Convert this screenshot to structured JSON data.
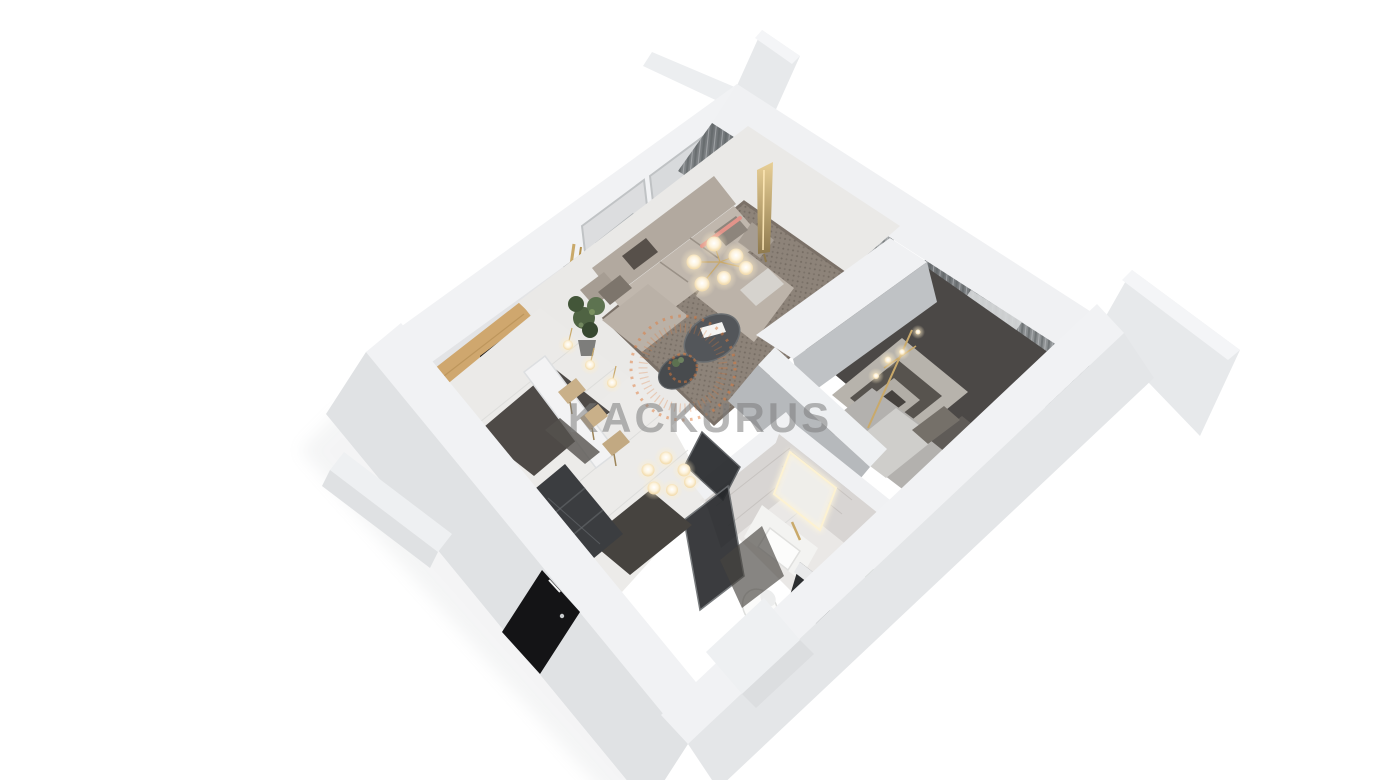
{
  "watermark": {
    "brand": "KACKURUS",
    "logo_color": "#e07a3a",
    "text_color": "#7d7d7d"
  },
  "scene": {
    "description": "3D cutaway floor-plan render of a one-bedroom apartment, viewed from above at an angle",
    "background": "#ffffff"
  },
  "palette": {
    "wall_top": "#f1f2f4",
    "wall_face_exterior": "#e2e4e6",
    "interior_wall_gray": "#a8acae",
    "curtain_dark": "#7c8083",
    "curtain_sheer": "#d9dadb",
    "sofa_beige": "#bdb4aa",
    "living_rug": "#8d8379",
    "bedroom_carpet": "#4b4846",
    "kitchen_rug": "#4e4a47",
    "wood_accent": "#cfa76e",
    "gold_accent": "#c9a96a",
    "appliance_black": "#141416",
    "marble": "#d8d5d3",
    "floor_tile": "#ebeae8",
    "glow_warm": "#ffe9bf"
  },
  "rooms": [
    {
      "name": "living-room"
    },
    {
      "name": "kitchen"
    },
    {
      "name": "hallway"
    },
    {
      "name": "bathroom"
    },
    {
      "name": "bedroom"
    },
    {
      "name": "entry"
    }
  ]
}
